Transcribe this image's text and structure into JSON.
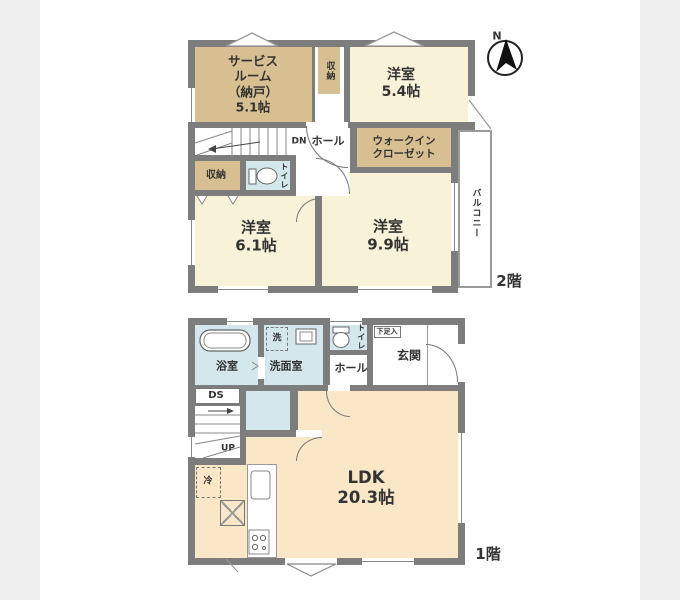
{
  "colors": {
    "wall": "#7d7d7d",
    "room_tan": "#d8bf92",
    "room_cream": "#f7f2d8",
    "room_blue": "#d4e7ec",
    "room_peach": "#fae7c7",
    "background_strip": "#efefef",
    "line": "#777777"
  },
  "compass": {
    "label": "N"
  },
  "second_floor": {
    "floor_label": "2階",
    "service_room": "サービス\nルーム\n（納戸）\n5.1帖",
    "closet_top": "収納",
    "bedroom_5_4": "洋室\n5.4帖",
    "stairs_dn": "DN",
    "hall": "ホール",
    "walk_in_closet": "ウォークイン\nクローゼット",
    "closet_left": "収納",
    "toilet": "トイレ",
    "bedroom_6_1": "洋室\n6.1帖",
    "bedroom_9_9": "洋室\n9.9帖",
    "balcony": "バルコニー"
  },
  "first_floor": {
    "floor_label": "1階",
    "bathroom": "浴室",
    "laundry": "洗",
    "washroom": "洗面室",
    "toilet": "トイレ",
    "shoe_cabinet": "下足入",
    "entrance": "玄関",
    "hall": "ホール",
    "duct_space": "DS",
    "stairs_up": "UP",
    "refrigerator": "冷",
    "ldk": "LDK\n20.3帖"
  }
}
